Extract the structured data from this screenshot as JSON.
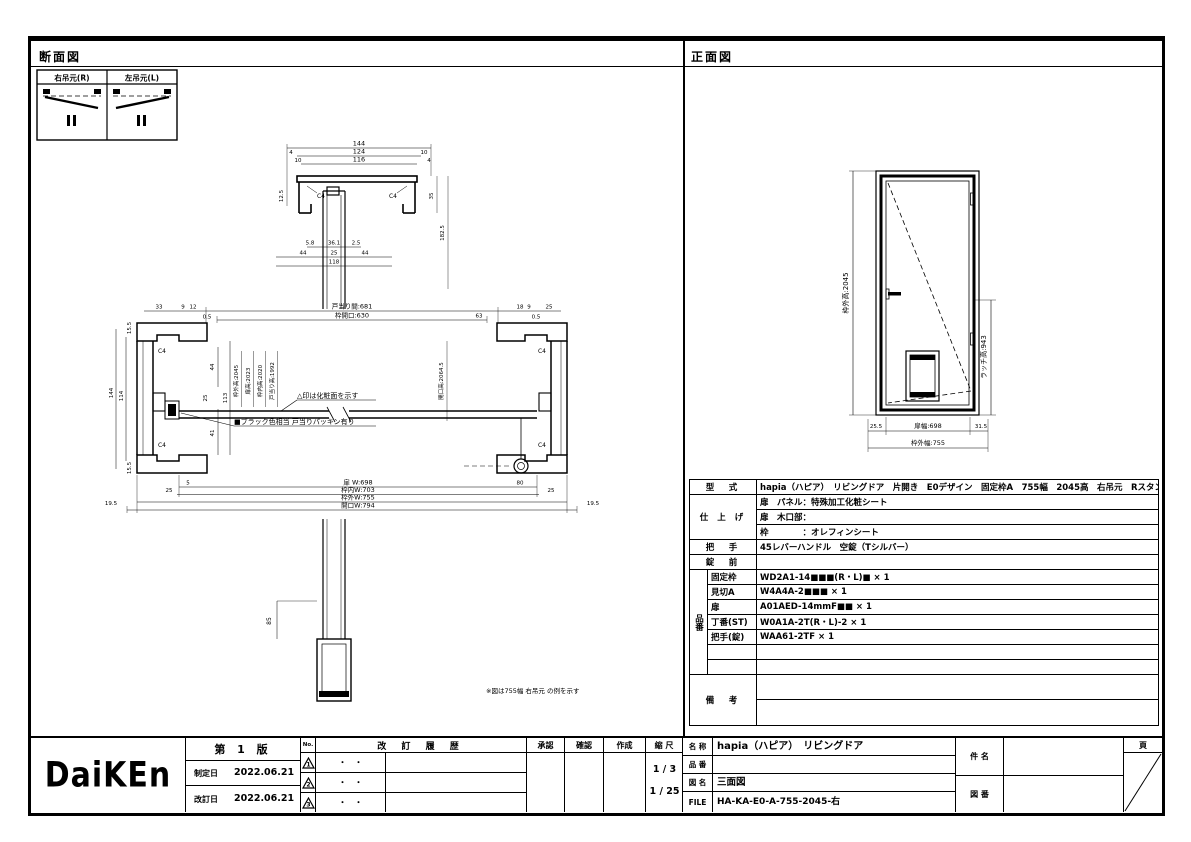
{
  "panels": {
    "section_title": "断面図",
    "front_title": "正面図"
  },
  "hinge_table": {
    "right": "右吊元(R)",
    "left": "左吊元(L)"
  },
  "section_view": {
    "head": {
      "d144": "144",
      "d124": "124",
      "d116": "116",
      "d4a": "4",
      "d10a": "10",
      "d10b": "10",
      "d4b": "4",
      "d125": "12.5",
      "d35": "35",
      "d1825": "182.5",
      "c4_left": "C4",
      "c4_right": "C4",
      "d58": "5.8",
      "d361": "36.1",
      "d25s": "2.5",
      "d44a": "44",
      "d25m": "25",
      "d44b": "44",
      "d118": "118"
    },
    "plan": {
      "top": {
        "d33": "33",
        "d9": "9",
        "d12": "12",
        "d05l": "0.5",
        "door_clear": "戸当り間:681",
        "frame_open": "枠開口:630",
        "d63": "63",
        "d18": "18",
        "d9b": "9",
        "d25": "25",
        "d05r": "0.5"
      },
      "left": {
        "d155t": "15.5",
        "d144": "144",
        "d114": "114",
        "d44": "44",
        "d25": "25",
        "d113": "113",
        "d41": "41",
        "d155b": "15.5"
      },
      "c4": "C4",
      "center_vlabels": [
        "枠外高:2045",
        "扉高:2023",
        "枠内高:2020",
        "戸当り高:1992"
      ],
      "right_vlabel": "開口高:2064.5",
      "note1": "△印は化粧面を示す",
      "note2": "■ブラック色相当 戸当りパッキン有り",
      "bottom": {
        "d5": "5",
        "d25l": "25",
        "d80": "80",
        "d25r": "25",
        "door_w": "扉 W:698",
        "frame_in_w": "枠内W:703",
        "frame_out_w": "枠外W:755",
        "wall_open_w": "開口W:794",
        "d195l": "19.5",
        "d195r": "19.5"
      },
      "d85": "85"
    },
    "footnote": "※図は755幅 右吊元 の例を示す"
  },
  "front_view": {
    "height_label": "枠外高:2045",
    "latch_label": "ラッチ高:943",
    "left_gap": "25.5",
    "door_width": "扉幅:698",
    "right_gap": "31.5",
    "frame_width": "枠外幅:755"
  },
  "spec": {
    "model_label": "型　式",
    "model_value": "hapia（ハピア）　リビングドア　片開き　E0デザイン　固定枠A　755幅　2045高　右吊元　Rスタンダード丁番",
    "finish_label": "仕 上 げ",
    "finish1": "扉　パネル：特殊加工化粧シート",
    "finish2": "扉　木口部：",
    "finish3": "枠　　　　：オレフィンシート",
    "handle_label": "把　手",
    "handle_value": "45レバーハンドル　空錠（Tシルバー）",
    "lock_label": "錠　前",
    "lock_value": "",
    "hinban_label": "品番",
    "items": [
      {
        "name": "固定枠",
        "value": "WD2A1-14■■■(R・L)■ × 1"
      },
      {
        "name": "見切A",
        "value": "W4A4A-2■■■ × 1"
      },
      {
        "name": "扉",
        "value": "A01AED-14mmF■■ × 1"
      },
      {
        "name": "丁番(ST)",
        "value": "W0A1A-2T(R・L)-2 × 1"
      },
      {
        "name": "把手(錠)",
        "value": "WAA61-2TF × 1"
      },
      {
        "name": "",
        "value": ""
      },
      {
        "name": "",
        "value": ""
      }
    ],
    "remarks_label": "備　考",
    "remarks_value1": "",
    "remarks_value2": ""
  },
  "title_block": {
    "logo": "DaiKEn",
    "edition": "第 1 版",
    "enacted_label": "制定日",
    "enacted_date": "2022.06.21",
    "revised_label": "改訂日",
    "revised_date": "2022.06.21",
    "no_label": "No.",
    "history_label": "改 訂 履 歴",
    "rev_rows": [
      {
        "no": "1",
        "date": "・　・"
      },
      {
        "no": "2",
        "date": "・　・"
      },
      {
        "no": "3",
        "date": "・　・"
      }
    ],
    "approve_label": "承認",
    "check_label": "確認",
    "create_label": "作成",
    "scale_label": "縮 尺",
    "scale1": "1 / 3",
    "scale2": "1 / 25",
    "name_label": "名 称",
    "name_value": "hapia（ハピア）　リビングドア",
    "hinban_label": "品 番",
    "hinban_value": "",
    "zumei_label": "図 名",
    "zumei_value": "三面図",
    "file_label": "FILE",
    "file_value": "HA-KA-E0-A-755-2045-右",
    "kenmei_label": "件 名",
    "kenmei_value": "",
    "zuban_label": "図 番",
    "zuban_value": "",
    "page_label": "頁"
  }
}
